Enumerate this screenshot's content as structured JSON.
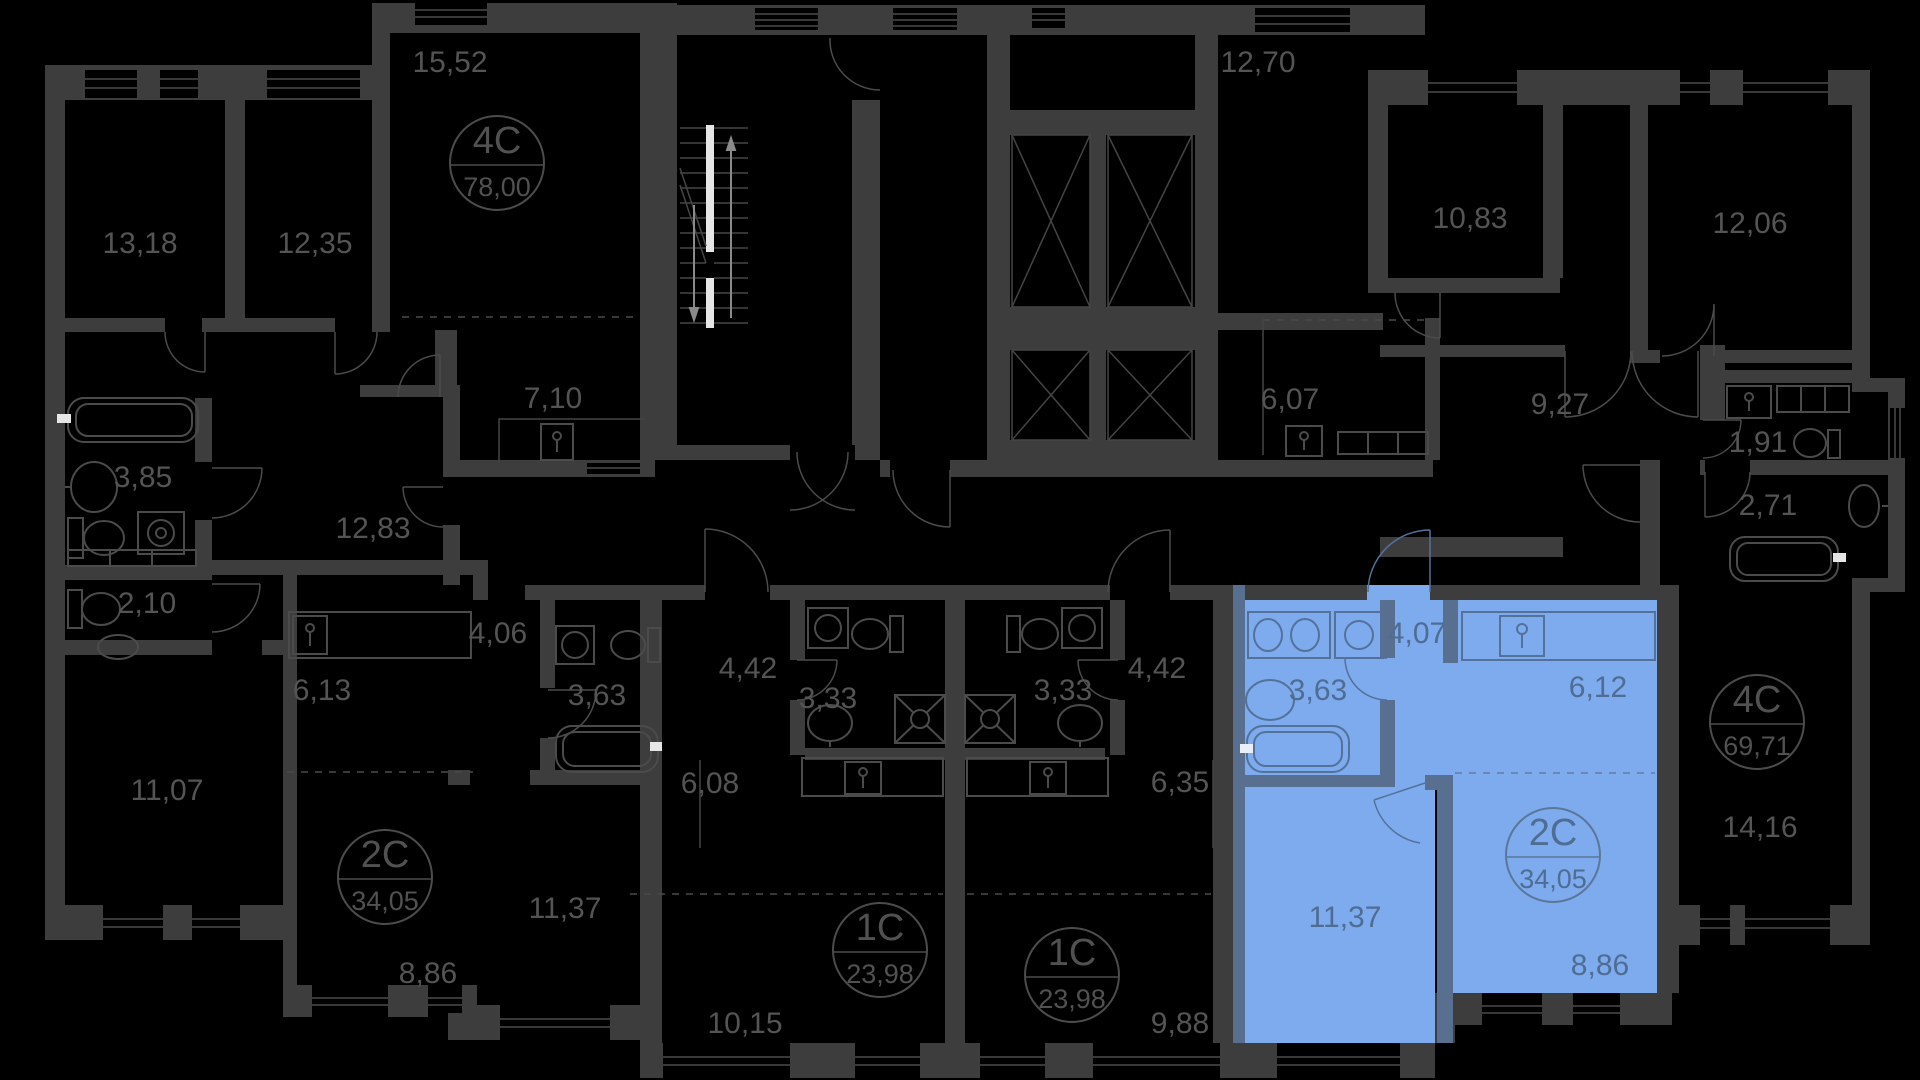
{
  "canvas": {
    "width": 1920,
    "height": 1080,
    "background": "#000000"
  },
  "palette": {
    "wall": "#3d3d3d",
    "fixture_line": "#4b4b4b",
    "label": "#545454",
    "highlight_fill": "#7dabee",
    "highlight_wall": "#596f90",
    "highlight_line": "#54719a",
    "highlight_label": "#4f6d94",
    "stair_accent": "#e6e6e6"
  },
  "apartments": [
    {
      "id": "apt-4c-left",
      "type_label": "4C",
      "total_area_label": "78,00",
      "highlighted": false,
      "badge": {
        "x": 497,
        "y": 163
      },
      "room_areas": [
        "13,18",
        "12,35",
        "15,52",
        "7,10",
        "3,85",
        "12,83",
        "2,10",
        "11,07"
      ]
    },
    {
      "id": "apt-2c-left",
      "type_label": "2C",
      "total_area_label": "34,05",
      "highlighted": false,
      "badge": {
        "x": 385,
        "y": 877
      },
      "room_areas": [
        "6,13",
        "4,06",
        "3,63",
        "11,37",
        "8,86"
      ]
    },
    {
      "id": "apt-1c-left",
      "type_label": "1C",
      "total_area_label": "23,98",
      "highlighted": false,
      "badge": {
        "x": 880,
        "y": 950
      },
      "room_areas": [
        "4,42",
        "3,33",
        "6,08",
        "10,15"
      ]
    },
    {
      "id": "apt-1c-right",
      "type_label": "1C",
      "total_area_label": "23,98",
      "highlighted": false,
      "badge": {
        "x": 1072,
        "y": 975
      },
      "room_areas": [
        "4,42",
        "3,33",
        "6,35",
        "9,88"
      ]
    },
    {
      "id": "apt-2c-highlighted",
      "type_label": "2C",
      "total_area_label": "34,05",
      "highlighted": true,
      "badge": {
        "x": 1553,
        "y": 855
      },
      "room_areas": [
        "4,07",
        "3,63",
        "6,12",
        "11,37",
        "8,86"
      ]
    },
    {
      "id": "apt-4c-right",
      "type_label": "4C",
      "total_area_label": "69,71",
      "highlighted": false,
      "badge": {
        "x": 1757,
        "y": 722
      },
      "room_areas": [
        "12,70",
        "6,07",
        "10,83",
        "12,06",
        "9,27",
        "1,91",
        "2,71",
        "14,16"
      ]
    }
  ],
  "room_labels": [
    {
      "text": "13,18",
      "x": 140,
      "y": 243,
      "highlighted": false
    },
    {
      "text": "12,35",
      "x": 315,
      "y": 243,
      "highlighted": false
    },
    {
      "text": "15,52",
      "x": 450,
      "y": 62,
      "highlighted": false
    },
    {
      "text": "7,10",
      "x": 553,
      "y": 398,
      "highlighted": false
    },
    {
      "text": "3,85",
      "x": 143,
      "y": 477,
      "highlighted": false
    },
    {
      "text": "12,83",
      "x": 373,
      "y": 528,
      "highlighted": false
    },
    {
      "text": "2,10",
      "x": 147,
      "y": 603,
      "highlighted": false
    },
    {
      "text": "11,07",
      "x": 167,
      "y": 790,
      "highlighted": false
    },
    {
      "text": "6,13",
      "x": 322,
      "y": 690,
      "highlighted": false
    },
    {
      "text": "4,06",
      "x": 498,
      "y": 633,
      "highlighted": false
    },
    {
      "text": "3,63",
      "x": 597,
      "y": 695,
      "highlighted": false
    },
    {
      "text": "11,37",
      "x": 565,
      "y": 908,
      "highlighted": false
    },
    {
      "text": "8,86",
      "x": 428,
      "y": 973,
      "highlighted": false
    },
    {
      "text": "4,42",
      "x": 748,
      "y": 668,
      "highlighted": false
    },
    {
      "text": "3,33",
      "x": 828,
      "y": 698,
      "highlighted": false
    },
    {
      "text": "6,08",
      "x": 710,
      "y": 783,
      "highlighted": false
    },
    {
      "text": "10,15",
      "x": 745,
      "y": 1023,
      "highlighted": false
    },
    {
      "text": "4,42",
      "x": 1157,
      "y": 668,
      "highlighted": false
    },
    {
      "text": "3,33",
      "x": 1063,
      "y": 690,
      "highlighted": false
    },
    {
      "text": "6,35",
      "x": 1180,
      "y": 782,
      "highlighted": false
    },
    {
      "text": "9,88",
      "x": 1180,
      "y": 1023,
      "highlighted": false
    },
    {
      "text": "12,70",
      "x": 1258,
      "y": 62,
      "highlighted": false
    },
    {
      "text": "6,07",
      "x": 1290,
      "y": 399,
      "highlighted": false
    },
    {
      "text": "10,83",
      "x": 1470,
      "y": 218,
      "highlighted": false
    },
    {
      "text": "12,06",
      "x": 1750,
      "y": 223,
      "highlighted": false
    },
    {
      "text": "9,27",
      "x": 1560,
      "y": 404,
      "highlighted": false
    },
    {
      "text": "1,91",
      "x": 1758,
      "y": 442,
      "highlighted": false
    },
    {
      "text": "2,71",
      "x": 1768,
      "y": 505,
      "highlighted": false
    },
    {
      "text": "14,16",
      "x": 1760,
      "y": 827,
      "highlighted": false
    },
    {
      "text": "4,07",
      "x": 1417,
      "y": 633,
      "highlighted": true
    },
    {
      "text": "3,63",
      "x": 1318,
      "y": 690,
      "highlighted": true
    },
    {
      "text": "6,12",
      "x": 1598,
      "y": 687,
      "highlighted": true
    },
    {
      "text": "11,37",
      "x": 1345,
      "y": 917,
      "highlighted": true
    },
    {
      "text": "8,86",
      "x": 1600,
      "y": 965,
      "highlighted": true
    }
  ]
}
